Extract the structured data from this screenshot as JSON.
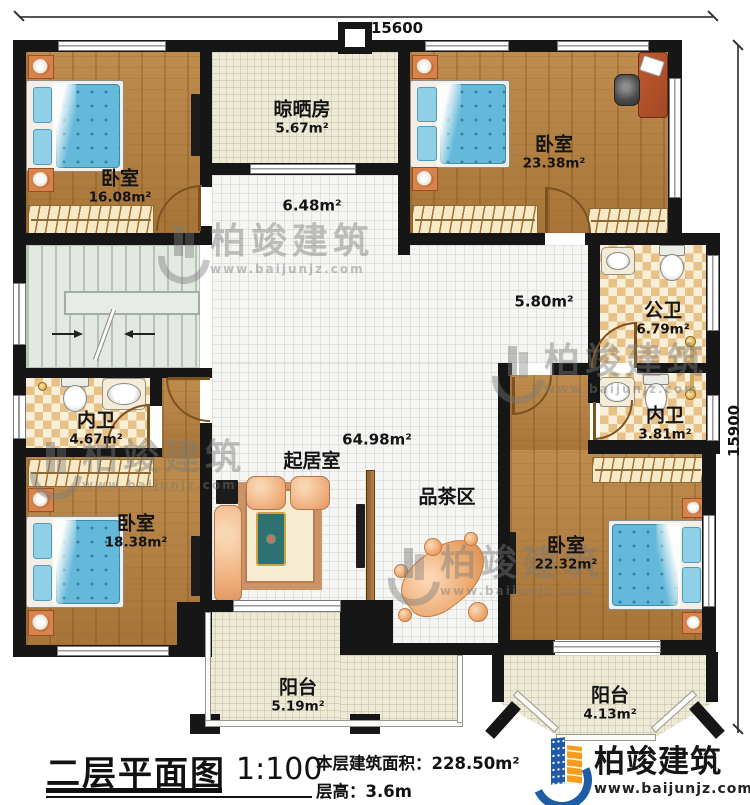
{
  "dimensions": {
    "top": "15600",
    "right": "15900"
  },
  "rooms": {
    "bedroom_tl": {
      "name": "卧室",
      "area": "16.08m²"
    },
    "drying_room": {
      "name": "晾晒房",
      "area": "5.67m²"
    },
    "bedroom_tr": {
      "name": "卧室",
      "area": "23.38m²"
    },
    "public_bath": {
      "name": "公卫",
      "area": "6.79m²"
    },
    "ensuite_right": {
      "name": "内卫",
      "area": "3.81m²"
    },
    "ensuite_left": {
      "name": "内卫",
      "area": "4.67m²"
    },
    "bedroom_bl": {
      "name": "卧室",
      "area": "18.38m²"
    },
    "bedroom_br": {
      "name": "卧室",
      "area": "22.32m²"
    },
    "living_room": {
      "name": "起居室",
      "area": "64.98m²"
    },
    "tea_area": {
      "name": "品茶区"
    },
    "balcony_left": {
      "name": "阳台",
      "area": "5.19m²"
    },
    "balcony_right": {
      "name": "阳台",
      "area": "4.13m²"
    }
  },
  "sub_areas": {
    "upper_hall": "6.48m²",
    "corridor": "5.80m²"
  },
  "title_block": {
    "title": "二层平面图",
    "scale": "1:100",
    "floor_area": "本层建筑面积：228.50m²",
    "floor_height": "层高：3.6m"
  },
  "brand": {
    "name": "柏竣建筑",
    "url": "www.baijunjz.com"
  },
  "watermark": {
    "name": "柏竣建筑",
    "url": "www.baijunjz.com"
  },
  "colors": {
    "wall": "#161616",
    "wood_floor": "#b07c3e",
    "tile_cream": "#edead8",
    "tile_white": "#f5f5f3",
    "bath_checker": "#e8c186",
    "bed_blue": "#64b9da",
    "sofa_peach": "#eba577",
    "stairs": "#e3e8e2",
    "logo_blue": "#1f5ca5",
    "logo_orange": "#f59d1f"
  }
}
